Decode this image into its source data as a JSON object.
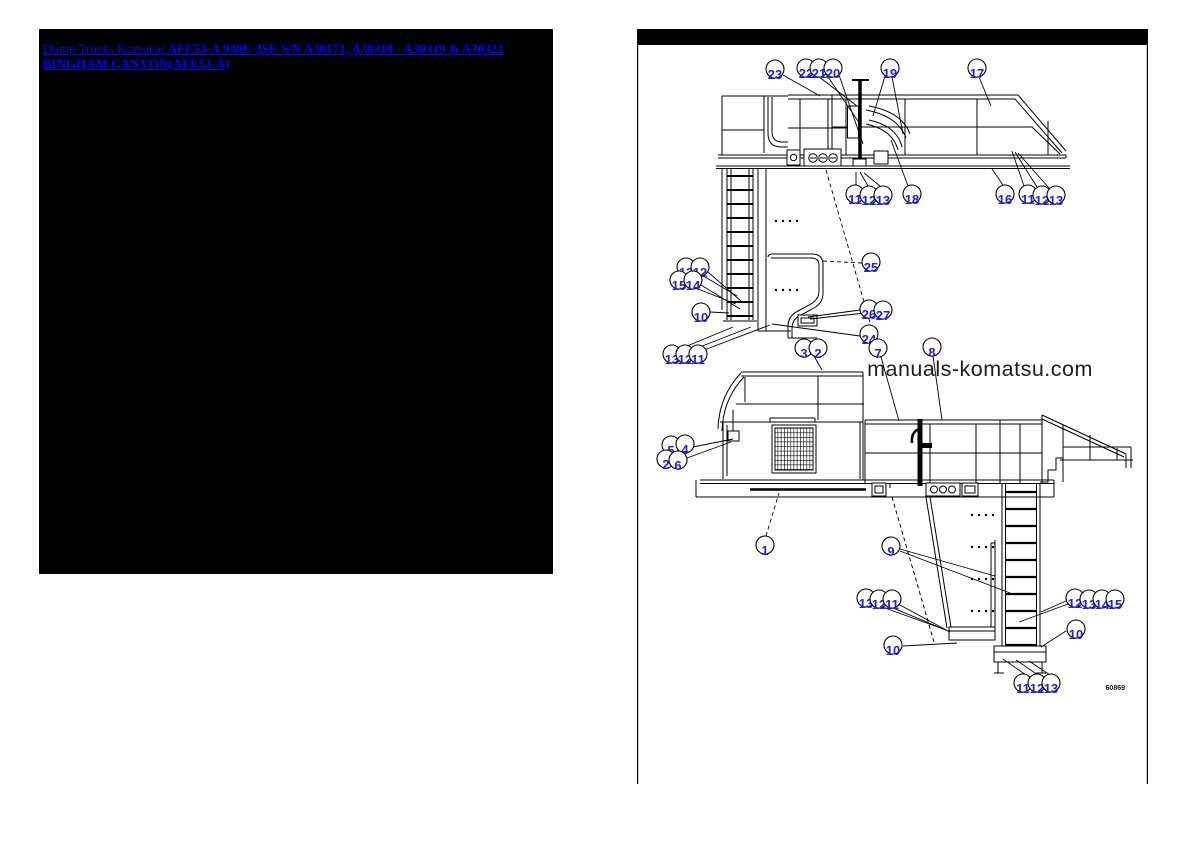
{
  "left_panel": {
    "breadcrumb_prefix": "Dump Trucks Komatsu ",
    "title": "AFE53-A 930E-3SE S/N A30171, A30318 - A30319 & A30322 BINGHAM CANYON(AFE53-A)",
    "link_color": "#0000ff",
    "background": "#000000"
  },
  "diagram": {
    "header_bar_color": "#000000",
    "watermark": "manuals-komatsu.com",
    "drawing_number": "60869",
    "callout_color": "#2222dd",
    "callouts": [
      {
        "n": "23",
        "x": 775,
        "y": 69
      },
      {
        "n": "22",
        "x": 806,
        "y": 68
      },
      {
        "n": "21",
        "x": 819,
        "y": 68
      },
      {
        "n": "20",
        "x": 833,
        "y": 68
      },
      {
        "n": "19",
        "x": 890,
        "y": 68
      },
      {
        "n": "17",
        "x": 977,
        "y": 68
      },
      {
        "n": "11",
        "x": 855,
        "y": 194
      },
      {
        "n": "12",
        "x": 869,
        "y": 195
      },
      {
        "n": "13",
        "x": 883,
        "y": 195
      },
      {
        "n": "18",
        "x": 912,
        "y": 194
      },
      {
        "n": "16",
        "x": 1005,
        "y": 194
      },
      {
        "n": "11",
        "x": 1028,
        "y": 194
      },
      {
        "n": "12",
        "x": 1042,
        "y": 195
      },
      {
        "n": "13",
        "x": 1056,
        "y": 195
      },
      {
        "n": "13",
        "x": 686,
        "y": 267
      },
      {
        "n": "12",
        "x": 700,
        "y": 267
      },
      {
        "n": "15",
        "x": 679,
        "y": 280
      },
      {
        "n": "14",
        "x": 693,
        "y": 280
      },
      {
        "n": "10",
        "x": 701,
        "y": 312
      },
      {
        "n": "25",
        "x": 871,
        "y": 262
      },
      {
        "n": "26",
        "x": 869,
        "y": 309
      },
      {
        "n": "27",
        "x": 883,
        "y": 310
      },
      {
        "n": "24",
        "x": 869,
        "y": 334
      },
      {
        "n": "7",
        "x": 878,
        "y": 348
      },
      {
        "n": "3",
        "x": 804,
        "y": 348
      },
      {
        "n": "2",
        "x": 818,
        "y": 348
      },
      {
        "n": "8",
        "x": 932,
        "y": 347
      },
      {
        "n": "13",
        "x": 672,
        "y": 354
      },
      {
        "n": "12",
        "x": 685,
        "y": 354
      },
      {
        "n": "11",
        "x": 698,
        "y": 354
      },
      {
        "n": "5",
        "x": 671,
        "y": 445
      },
      {
        "n": "4",
        "x": 685,
        "y": 444
      },
      {
        "n": "2",
        "x": 666,
        "y": 459
      },
      {
        "n": "6",
        "x": 678,
        "y": 460
      },
      {
        "n": "1",
        "x": 765,
        "y": 545
      },
      {
        "n": "9",
        "x": 891,
        "y": 546
      },
      {
        "n": "13",
        "x": 866,
        "y": 598
      },
      {
        "n": "12",
        "x": 879,
        "y": 599
      },
      {
        "n": "11",
        "x": 892,
        "y": 599
      },
      {
        "n": "12",
        "x": 1075,
        "y": 598
      },
      {
        "n": "13",
        "x": 1089,
        "y": 599
      },
      {
        "n": "14",
        "x": 1102,
        "y": 599
      },
      {
        "n": "15",
        "x": 1115,
        "y": 599
      },
      {
        "n": "10",
        "x": 1076,
        "y": 629
      },
      {
        "n": "10",
        "x": 893,
        "y": 645
      },
      {
        "n": "11",
        "x": 1023,
        "y": 683
      },
      {
        "n": "12",
        "x": 1037,
        "y": 683
      },
      {
        "n": "13",
        "x": 1051,
        "y": 683
      }
    ],
    "leaders": [
      {
        "x1": 783,
        "y1": 75,
        "x2": 820,
        "y2": 96
      },
      {
        "x1": 814,
        "y1": 73,
        "x2": 857,
        "y2": 106
      },
      {
        "x1": 826,
        "y1": 74,
        "x2": 860,
        "y2": 124
      },
      {
        "x1": 839,
        "y1": 75,
        "x2": 863,
        "y2": 144
      },
      {
        "x1": 885,
        "y1": 76,
        "x2": 873,
        "y2": 116
      },
      {
        "x1": 892,
        "y1": 77,
        "x2": 903,
        "y2": 134
      },
      {
        "x1": 979,
        "y1": 77,
        "x2": 991,
        "y2": 106
      },
      {
        "x1": 856,
        "y1": 185,
        "x2": 856,
        "y2": 172
      },
      {
        "x1": 868,
        "y1": 186,
        "x2": 860,
        "y2": 172
      },
      {
        "x1": 880,
        "y1": 186,
        "x2": 864,
        "y2": 173
      },
      {
        "x1": 908,
        "y1": 186,
        "x2": 891,
        "y2": 140
      },
      {
        "x1": 1003,
        "y1": 185,
        "x2": 992,
        "y2": 169
      },
      {
        "x1": 1024,
        "y1": 186,
        "x2": 1012,
        "y2": 151
      },
      {
        "x1": 1037,
        "y1": 187,
        "x2": 1015,
        "y2": 152
      },
      {
        "x1": 1049,
        "y1": 188,
        "x2": 1018,
        "y2": 153
      },
      {
        "x1": 695,
        "y1": 271,
        "x2": 737,
        "y2": 296
      },
      {
        "x1": 708,
        "y1": 272,
        "x2": 741,
        "y2": 301
      },
      {
        "x1": 688,
        "y1": 285,
        "x2": 736,
        "y2": 304
      },
      {
        "x1": 701,
        "y1": 285,
        "x2": 740,
        "y2": 309
      },
      {
        "x1": 710,
        "y1": 312,
        "x2": 729,
        "y2": 313
      },
      {
        "x1": 862,
        "y1": 263,
        "x2": 823,
        "y2": 261,
        "d": 1
      },
      {
        "x1": 860,
        "y1": 310,
        "x2": 808,
        "y2": 317
      },
      {
        "x1": 874,
        "y1": 312,
        "x2": 810,
        "y2": 319
      },
      {
        "x1": 860,
        "y1": 336,
        "x2": 772,
        "y2": 324
      },
      {
        "x1": 826,
        "y1": 170,
        "x2": 875,
        "y2": 340,
        "d": 1
      },
      {
        "x1": 881,
        "y1": 357,
        "x2": 899,
        "y2": 421
      },
      {
        "x1": 814,
        "y1": 356,
        "x2": 822,
        "y2": 370
      },
      {
        "x1": 933,
        "y1": 356,
        "x2": 942,
        "y2": 420
      },
      {
        "x1": 680,
        "y1": 349,
        "x2": 733,
        "y2": 327
      },
      {
        "x1": 692,
        "y1": 350,
        "x2": 751,
        "y2": 327
      },
      {
        "x1": 704,
        "y1": 350,
        "x2": 770,
        "y2": 325
      },
      {
        "x1": 693,
        "y1": 447,
        "x2": 733,
        "y2": 439
      },
      {
        "x1": 687,
        "y1": 458,
        "x2": 731,
        "y2": 442
      },
      {
        "x1": 766,
        "y1": 536,
        "x2": 779,
        "y2": 493,
        "d": 1
      },
      {
        "x1": 900,
        "y1": 549,
        "x2": 995,
        "y2": 576
      },
      {
        "x1": 900,
        "y1": 551,
        "x2": 1010,
        "y2": 593
      },
      {
        "x1": 874,
        "y1": 604,
        "x2": 946,
        "y2": 630
      },
      {
        "x1": 886,
        "y1": 605,
        "x2": 948,
        "y2": 631
      },
      {
        "x1": 898,
        "y1": 604,
        "x2": 950,
        "y2": 632
      },
      {
        "x1": 1066,
        "y1": 601,
        "x2": 1041,
        "y2": 612
      },
      {
        "x1": 1068,
        "y1": 604,
        "x2": 1019,
        "y2": 622
      },
      {
        "x1": 1066,
        "y1": 631,
        "x2": 1041,
        "y2": 647
      },
      {
        "x1": 903,
        "y1": 646,
        "x2": 957,
        "y2": 643
      },
      {
        "x1": 1026,
        "y1": 675,
        "x2": 1003,
        "y2": 659
      },
      {
        "x1": 1038,
        "y1": 675,
        "x2": 1016,
        "y2": 660
      },
      {
        "x1": 1050,
        "y1": 675,
        "x2": 1029,
        "y2": 661
      }
    ]
  }
}
